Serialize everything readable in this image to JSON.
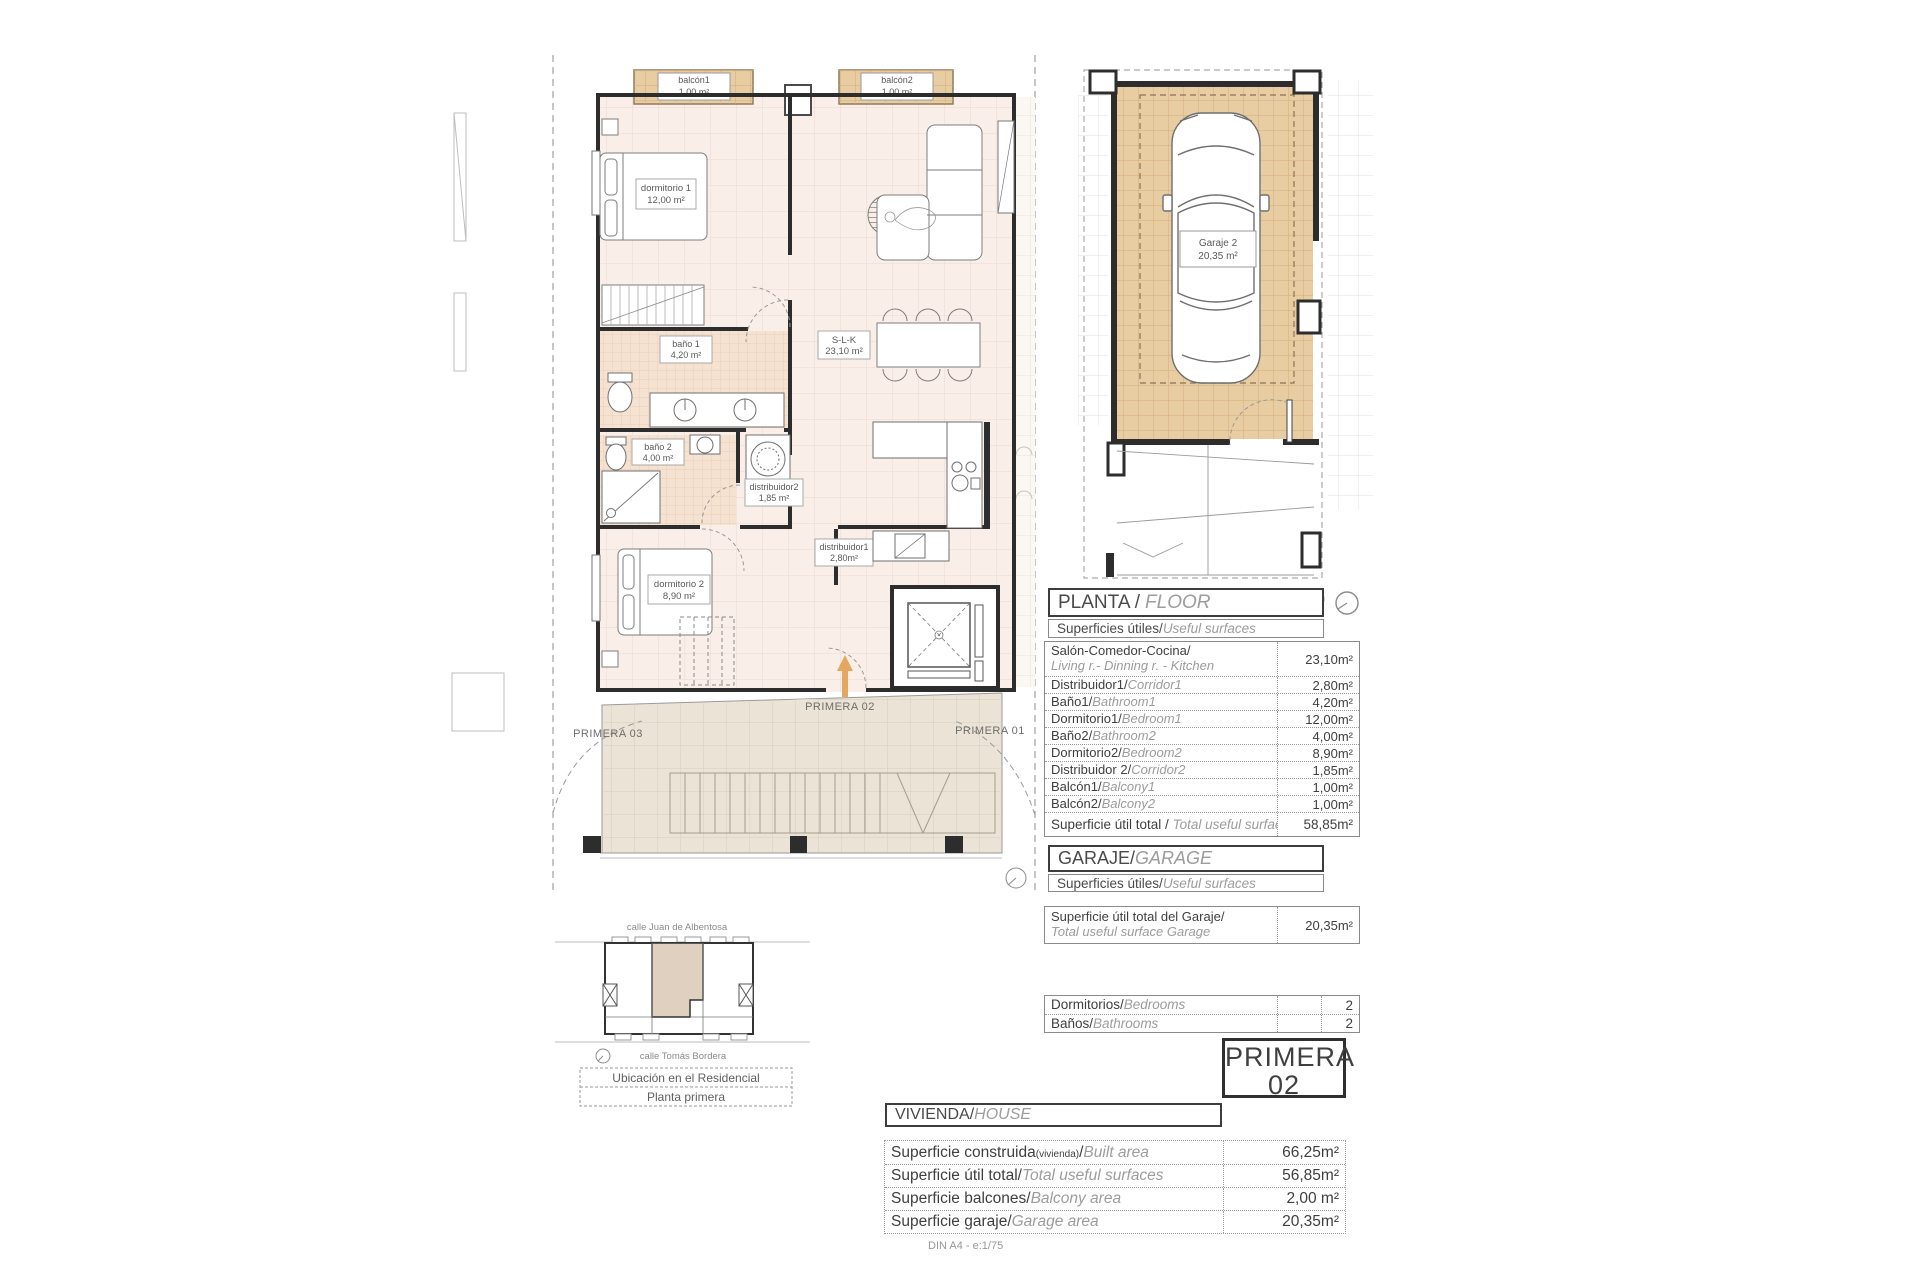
{
  "plan": {
    "rooms": {
      "dormitorio1": {
        "name": "dormitorio 1",
        "area": "12,00 m²"
      },
      "dormitorio2": {
        "name": "dormitorio 2",
        "area": "8,90 m²"
      },
      "bano1": {
        "name": "baño 1",
        "area": "4,20 m²"
      },
      "bano2": {
        "name": "baño 2",
        "area": "4,00 m²"
      },
      "distribuidor1": {
        "name": "distribuidor1",
        "area": "2,80m²"
      },
      "distribuidor2": {
        "name": "distribuidor2",
        "area": "1,85 m²"
      },
      "slk": {
        "name": "S-L-K",
        "area": "23,10 m²"
      },
      "balcon1": {
        "name": "balcón1",
        "area": "1,00 m²"
      },
      "balcon2": {
        "name": "balcón2",
        "area": "1,00 m²"
      }
    },
    "units": {
      "left": "PRIMERA 03",
      "center": "PRIMERA 02",
      "right": "PRIMERA 01"
    }
  },
  "garage_plan": {
    "name": "Garaje 2",
    "area": "20,35 m²"
  },
  "planta": {
    "title_es": "PLANTA /",
    "title_en": "FLOOR",
    "sub_es": "Superficies útiles/",
    "sub_en": "Useful surfaces",
    "rows": [
      {
        "es": "Salón-Comedor-Cocina/",
        "en": "Living r.- Dinning r. - Kitchen",
        "value": "23,10m²"
      },
      {
        "es": "Distribuidor1/",
        "en": "Corridor1",
        "value": "2,80m²"
      },
      {
        "es": "Baño1/",
        "en": "Bathroom1",
        "value": "4,20m²"
      },
      {
        "es": "Dormitorio1/",
        "en": "Bedroom1",
        "value": "12,00m²"
      },
      {
        "es": "Baño2/",
        "en": "Bathroom2",
        "value": "4,00m²"
      },
      {
        "es": "Dormitorio2/",
        "en": "Bedroom2",
        "value": "8,90m²"
      },
      {
        "es": "Distribuidor 2/",
        "en": "Corridor2",
        "value": "1,85m²"
      },
      {
        "es": "Balcón1/",
        "en": "Balcony1",
        "value": "1,00m²"
      },
      {
        "es": "Balcón2/",
        "en": "Balcony2",
        "value": "1,00m²"
      }
    ],
    "total_es": "Superficie útil total / ",
    "total_en": "Total useful surface",
    "total_value": "58,85m²"
  },
  "garaje": {
    "title_es": "GARAJE/",
    "title_en": "GARAGE",
    "sub_es": "Superficies útiles/",
    "sub_en": "Useful surfaces",
    "row_es": "Superficie útil total del Garaje/",
    "row_en": "Total useful surface Garage",
    "row_value": "20,35m²"
  },
  "counts": {
    "rows": [
      {
        "es": "Dormitorios/",
        "en": "Bedrooms",
        "value": "2"
      },
      {
        "es": "Baños/",
        "en": "Bathrooms",
        "value": "2"
      }
    ]
  },
  "unit_badge": {
    "line1": "PRIMERA",
    "line2": "02"
  },
  "vivienda": {
    "title_es": "VIVIENDA/",
    "title_en": "HOUSE",
    "rows": [
      {
        "es": "Superficie construida",
        "small": "(vivienda)",
        "mid": "/",
        "en": "Built area",
        "value": "66,25m²"
      },
      {
        "es": "Superficie útil total/",
        "en": "Total useful surfaces",
        "value": "56,85m²"
      },
      {
        "es": "Superficie balcones/",
        "en": "Balcony area",
        "value": "2,00 m²"
      },
      {
        "es": "Superficie garaje/",
        "en": "Garage area",
        "value": "20,35m²"
      }
    ],
    "note": "DIN A4 - e:1/75"
  },
  "minimap": {
    "street_top": "calle Juan de Albentosa",
    "street_bottom": "calle Tomás Bordera",
    "caption_line1": "Ubicación en el Residencial",
    "caption_line2": "Planta primera"
  },
  "colors": {
    "accent_arrow": "#e4a75f",
    "tile_tan": "#e8cda3",
    "floor_pink": "#f9efe8"
  }
}
